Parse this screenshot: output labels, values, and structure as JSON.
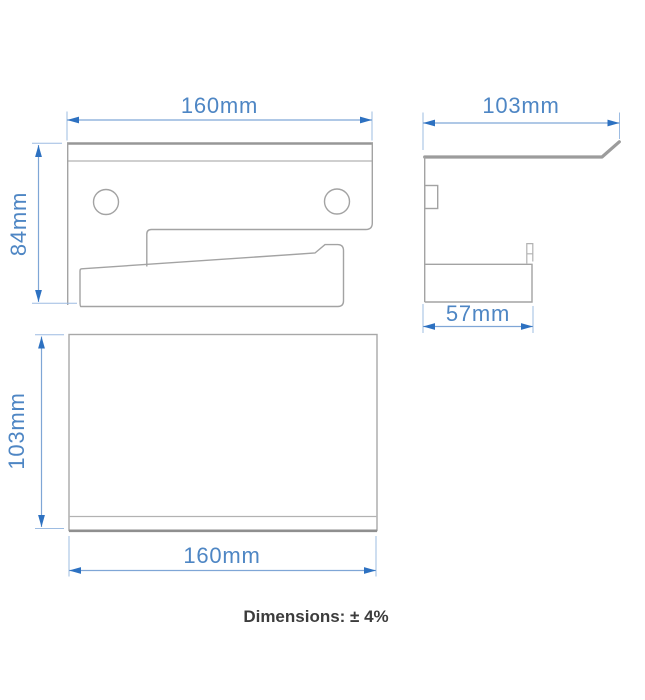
{
  "drawing": {
    "front_view": {
      "width": "160mm",
      "height": "84mm"
    },
    "side_view": {
      "depth": "103mm",
      "base_depth": "57mm"
    },
    "top_view": {
      "depth": "103mm",
      "width": "160mm"
    },
    "tolerance_note": "Dimensions: ± 4%"
  },
  "colors": {
    "dimension_text": "#4e86c4",
    "dimension_arrow": "#2d71c1",
    "dimension_line": "#7fa6d6",
    "outline_gray": "#a3a3a3",
    "note_text": "#3c3c3c",
    "background": "#ffffff"
  }
}
